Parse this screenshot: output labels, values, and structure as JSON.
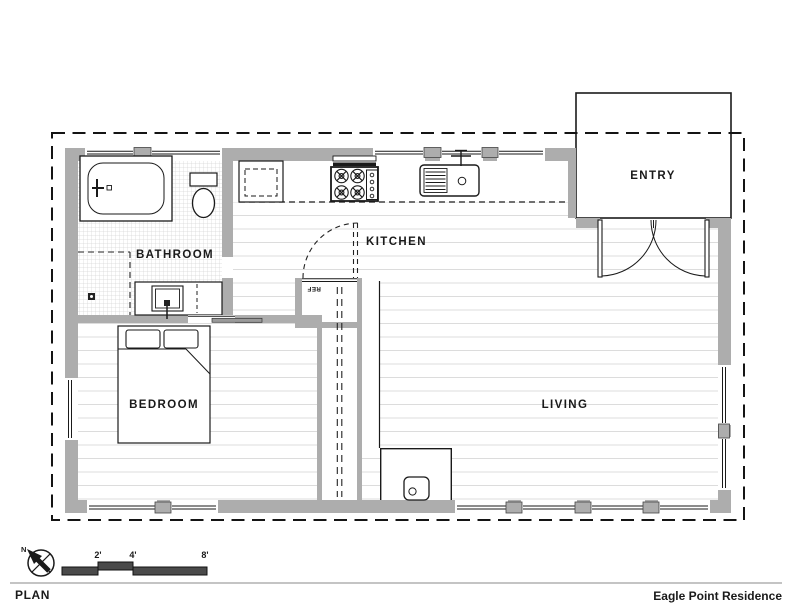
{
  "sheet": {
    "title": "PLAN",
    "project": "Eagle Point Residence"
  },
  "rooms": {
    "bathroom": "BATHROOM",
    "kitchen": "KITCHEN",
    "entry": "ENTRY",
    "bedroom": "BEDROOM",
    "living": "LIVING"
  },
  "appliances": {
    "refrigerator": "REF"
  },
  "compass": {
    "north_label": "N"
  },
  "scale_bar": {
    "ticks": [
      "2'",
      "4'",
      "8'"
    ]
  },
  "colors": {
    "paper": "#ffffff",
    "ink": "#1a1a1a",
    "wall_fill": "#adadad",
    "floor_line": "#dcdcdc",
    "tile_line": "#d6d6d6",
    "scale_bar_fill": "#4a4a4a",
    "title_rule": "#b0b0b0"
  }
}
